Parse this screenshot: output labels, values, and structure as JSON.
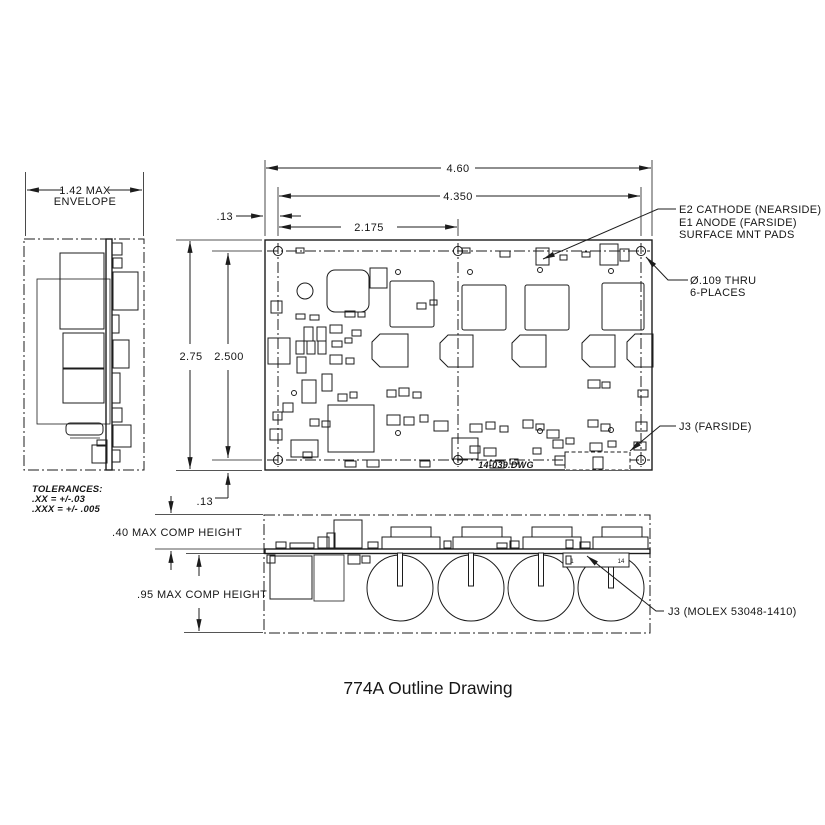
{
  "title": "774A Outline Drawing",
  "board_text": {
    "drawing_file": "14-039.DWG"
  },
  "dimensions": {
    "overall_width": "4.60",
    "hole_span_width": "4.350",
    "hole_half_span": "2.175",
    "edge_margin_top": ".13",
    "edge_margin_bottom": ".13",
    "envelope_width_line1": "1.42 MAX",
    "envelope_width_line2": "ENVELOPE",
    "overall_height": "2.75",
    "hole_span_height": "2.500",
    "top_comp_height": ".40 MAX COMP HEIGHT",
    "bottom_comp_height": ".95 MAX COMP HEIGHT"
  },
  "notes": {
    "pads_line1": "E2 CATHODE (NEARSIDE)",
    "pads_line2": "E1 ANODE (FARSIDE)",
    "pads_line3": "SURFACE MNT PADS",
    "holes_line1": "Ø.109 THRU",
    "holes_line2": "6-PLACES",
    "j3_farside": "J3 (FARSIDE)",
    "j3_molex": "J3 (MOLEX 53048-1410)"
  },
  "tolerances": {
    "heading": "TOLERANCES:",
    "line1": ".XX = +/-.03",
    "line2": ".XXX = +/- .005"
  },
  "connector_pins": {
    "first": "1",
    "last": "14"
  },
  "colors": {
    "ink": "#1c1c1c",
    "paper": "#ffffff"
  }
}
